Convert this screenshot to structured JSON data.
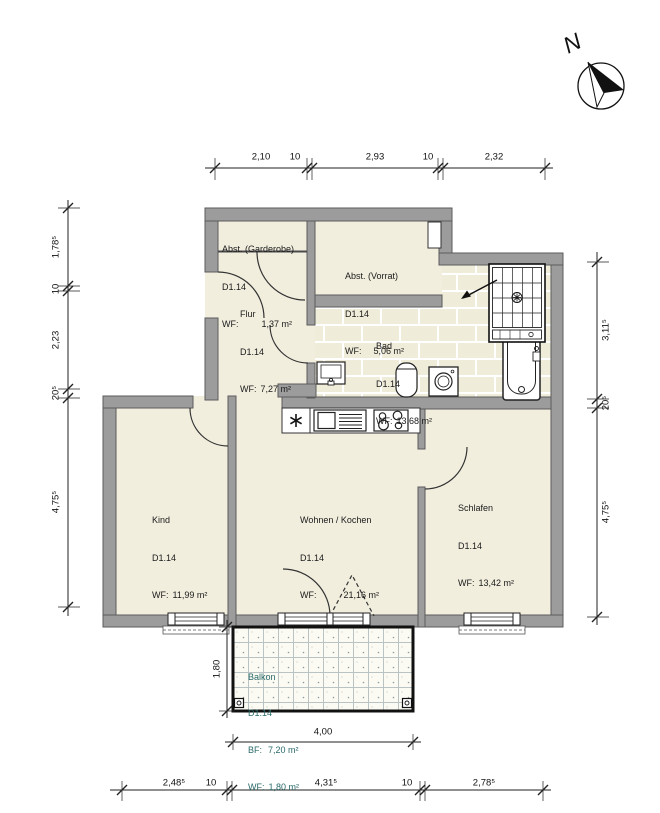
{
  "meta": {
    "compass_label": "N"
  },
  "rooms": {
    "garderobe": {
      "name": "Abst. (Garderobe)",
      "id": "D1.14",
      "wf_label": "WF:",
      "wf_value": "1,37 m²"
    },
    "vorrat": {
      "name": "Abst. (Vorrat)",
      "id": "D1.14",
      "wf_label": "WF:",
      "wf_value": "5,06 m²"
    },
    "flur": {
      "name": "Flur",
      "id": "D1.14",
      "wf_label": "WF:",
      "wf_value": "7,27 m²"
    },
    "bad": {
      "name": "Bad",
      "id": "D1.14",
      "wf_label": "WF:",
      "wf_value": "13,68 m²"
    },
    "kind": {
      "name": "Kind",
      "id": "D1.14",
      "wf_label": "WF:",
      "wf_value": "11,99 m²"
    },
    "wohnen": {
      "name": "Wohnen / Kochen",
      "id": "D1.14",
      "wf_label": "WF:",
      "wf_value": "21,16 m²"
    },
    "schlafen": {
      "name": "Schlafen",
      "id": "D1.14",
      "wf_label": "WF:",
      "wf_value": "13,42 m²"
    },
    "balkon": {
      "name": "Balkon",
      "id": "D1.14",
      "bf_label": "BF:",
      "bf_value": "7,20 m²",
      "wf_label": "WF:",
      "wf_value": "1,80 m²"
    }
  },
  "dimensions": {
    "top": [
      "2,10",
      "10",
      "2,93",
      "10",
      "2,32"
    ],
    "bottom": [
      "2,48⁵",
      "10",
      "4,31⁵",
      "10",
      "2,78⁵"
    ],
    "left": [
      "1,78⁵",
      "10",
      "2,23",
      "20⁵",
      "4,75⁵"
    ],
    "right": [
      "3,11⁵",
      "20⁵",
      "4,75⁵"
    ],
    "balcony_width": "4,00",
    "balcony_depth": "1,80"
  },
  "colors": {
    "wall": "#9c9c9c",
    "floor": "#f1eede",
    "tile_joint": "#ffffff",
    "balcony_text": "#2b6a6a",
    "line": "#222222"
  }
}
